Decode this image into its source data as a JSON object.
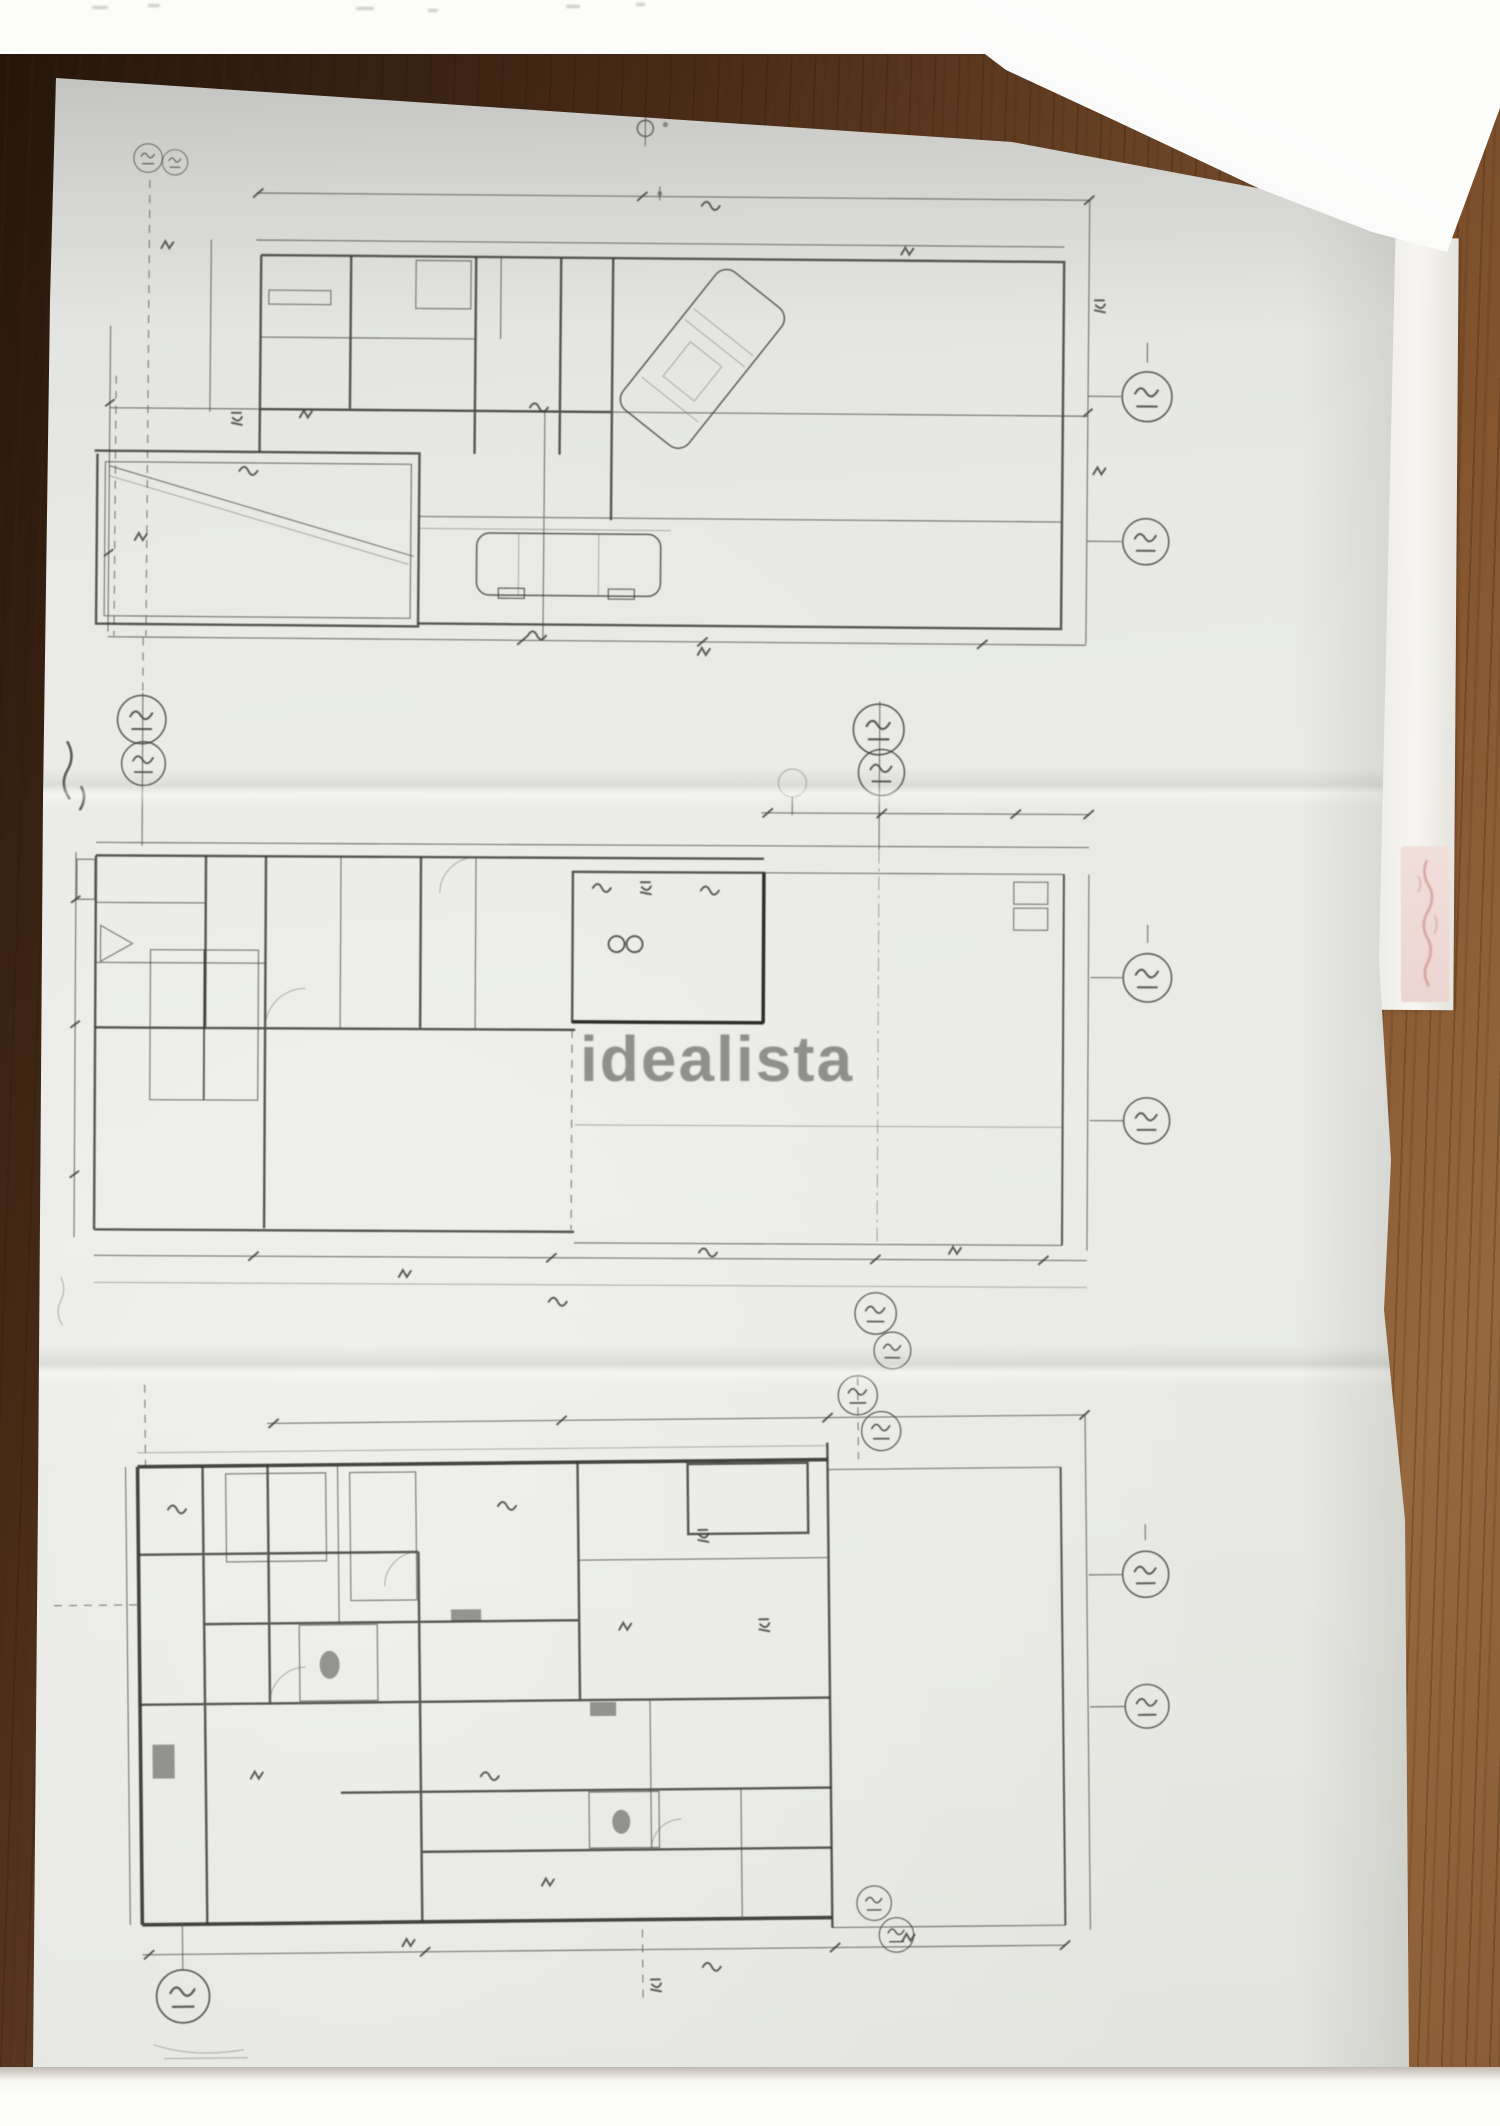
{
  "watermark": {
    "text": "idealista"
  },
  "scene": {
    "plans_visible": 3,
    "colors": {
      "paper": "#e9eae6",
      "wood_dark": "#23150b",
      "wood_light": "#93663d",
      "sticky_note": "#f0dcd8",
      "watermark_gray": "#7a7a77",
      "ink": "#30302e"
    }
  }
}
